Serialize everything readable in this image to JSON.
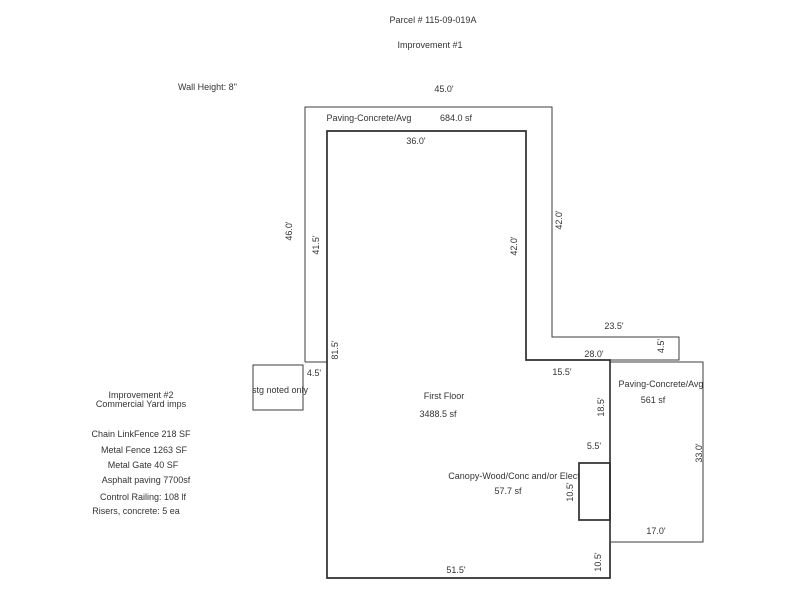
{
  "page": {
    "title": "Parcel # 115-09-019A",
    "subtitle": "Improvement #1",
    "wall_height": "Wall Height: 8\""
  },
  "sketch": {
    "outer_paving": {
      "name": "Paving-Concrete/Avg",
      "area": "684.0 sf",
      "dims": {
        "top": "45.0'",
        "right": "42.0'",
        "ext_top": "23.5'",
        "ext_right": "4.5'",
        "ext_bottom": "28.0'",
        "inner_right": "42.0'",
        "inner_left": "41.5'",
        "left": "46.0'",
        "bottom_left": "4.5'"
      }
    },
    "first_floor": {
      "name": "First Floor",
      "area": "3488.5 sf",
      "dims": {
        "top": "36.0'",
        "step": "15.5'",
        "right_mid": "18.5'",
        "right_lower": "10.5'",
        "bottom": "51.5'",
        "left": "81.5'"
      }
    },
    "right_paving": {
      "name": "Paving-Concrete/Avg",
      "area": "561 sf",
      "dims": {
        "right": "33.0'",
        "bottom": "17.0'"
      }
    },
    "canopy": {
      "name": "Canopy-Wood/Conc and/or Elect",
      "area": "57.7 sf",
      "dims": {
        "top": "5.5'",
        "left": "10.5'"
      }
    },
    "storage": {
      "name": "stg noted only"
    }
  },
  "improvement2": {
    "heading_line1": "Improvement #2",
    "heading_line2": "Commercial Yard imps",
    "items": [
      "Chain LinkFence 218 SF",
      "Metal Fence 1263 SF",
      "Metal Gate 40 SF",
      "Asphalt paving 7700sf",
      "Control Railing: 108 lf",
      "Risers, concrete: 5 ea"
    ]
  }
}
